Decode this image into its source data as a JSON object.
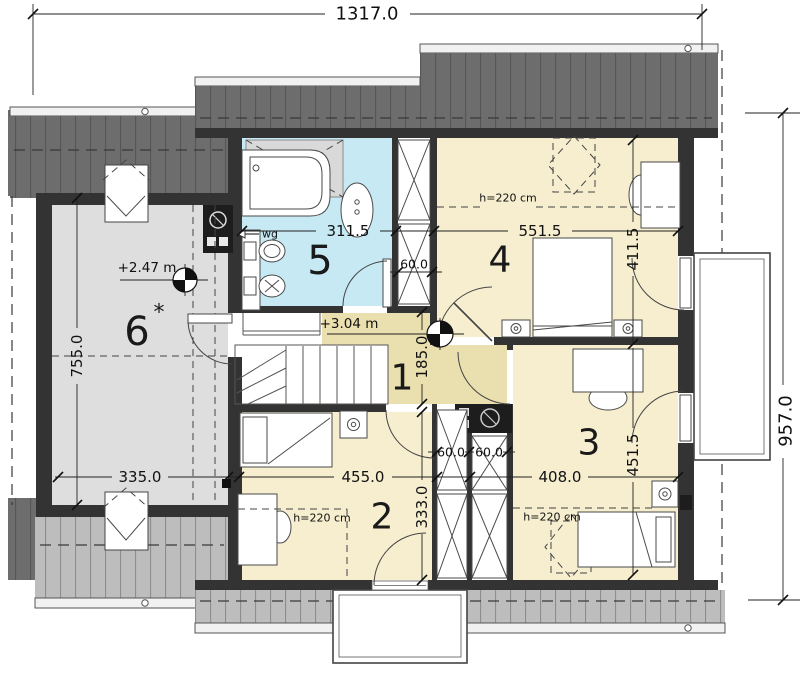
{
  "drawing": {
    "type": "attic-floor-plan",
    "overall": {
      "width_cm": "1317.0",
      "height_cm": "957.0"
    }
  },
  "rooms": {
    "hall": {
      "number": "1",
      "level": "+3.04 m",
      "depth": "185.0"
    },
    "bedroom2": {
      "number": "2",
      "width": "455.0",
      "depth": "333.0",
      "height_note": "h=220 cm"
    },
    "bedroom3": {
      "number": "3",
      "width": "408.0",
      "depth": "451.5",
      "height_note": "h=220 cm"
    },
    "bedroom4": {
      "number": "4",
      "width": "551.5",
      "depth": "411.5",
      "height_note": "h=220 cm"
    },
    "bathroom": {
      "number": "5",
      "width": "311.5",
      "vent_label": "wg"
    },
    "attic": {
      "number": "6",
      "suffix": "*",
      "level": "+2.47 m",
      "width": "335.0",
      "depth": "755.0"
    }
  },
  "closets": {
    "top": "60.0",
    "left": "60.0",
    "right": "60.0"
  },
  "colors": {
    "wall": "#333333",
    "bedroom": "#f6eecf",
    "bathroom": "#c6e9f4",
    "hall": "#eadfae",
    "attic": "#dedede",
    "roof_dark": "#6d6d6d",
    "roof_light": "#bdbdbd"
  }
}
